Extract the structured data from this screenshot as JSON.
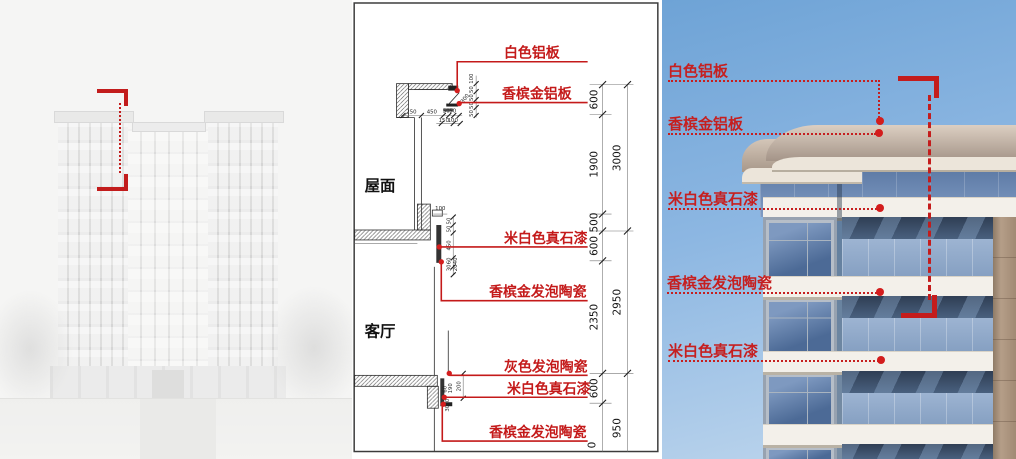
{
  "colors": {
    "annotation_red": "#c41c1c",
    "sky_top": "#6ea3d6",
    "sky_bottom": "#c3d9ee",
    "champagne_band": "#b3a294",
    "stone_band_white": "#f3f0ea",
    "glass_blue": "#8fa9ca"
  },
  "middle_panel": {
    "room_labels": {
      "roof": "屋面",
      "living_room": "客厅"
    },
    "material_callouts": [
      {
        "text": "白色铝板"
      },
      {
        "text": "香槟金铝板"
      },
      {
        "text": "米白色真石漆"
      },
      {
        "text": "香槟金发泡陶瓷"
      },
      {
        "text": "灰色发泡陶瓷"
      },
      {
        "text": "米白色真石漆"
      },
      {
        "text": "香槟金发泡陶瓷"
      }
    ],
    "dims_inner": [
      "600",
      "1900",
      "500",
      "600",
      "2350",
      "600",
      "0"
    ],
    "dims_outer": [
      "3000",
      "2950",
      "950"
    ],
    "detail_top_dims_h": [
      "250",
      "450",
      "50",
      "50",
      "150",
      "100"
    ],
    "detail_top_dims_v": [
      "100",
      "50",
      "50",
      "50",
      "50",
      "300"
    ],
    "detail_mid_dims": [
      "100",
      "50",
      "50",
      "450",
      "60",
      "40",
      "30",
      "20"
    ],
    "detail_bottom_dims": [
      "200",
      "190",
      "60",
      "30",
      "30"
    ]
  },
  "right_panel": {
    "material_callouts": [
      {
        "text": "白色铝板"
      },
      {
        "text": "香槟金铝板"
      },
      {
        "text": "米白色真石漆"
      },
      {
        "text": "香槟金发泡陶瓷"
      },
      {
        "text": "米白色真石漆"
      }
    ]
  }
}
